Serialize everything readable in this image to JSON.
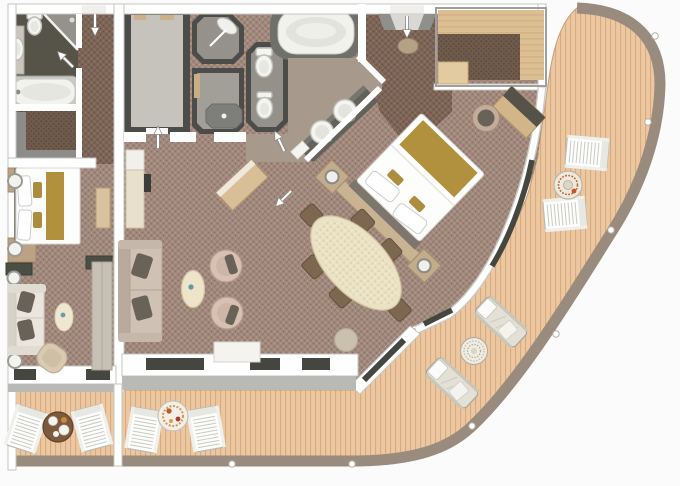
{
  "alt": "Top-down architectural floor plan of a two-bedroom ship suite with bathrooms, walk-in closets, living-dining room and a large curved teak balcony with deck furniture. No text labels are rendered in the image.",
  "visible_text": [],
  "colors": {
    "bg": "#fbfbfb",
    "wall": "#ffffff",
    "wall-edge": "#c6c6c3",
    "carpet-base": "#a28b7e",
    "carpet-dot-dark": "#8b7266",
    "carpet-dot-light": "#b59e90",
    "corridor-base": "#7d6557",
    "corridor-dot-dark": "#6a5244",
    "corridor-dot-light": "#8f7868",
    "closet-floor-base": "#6e5b4c",
    "closet-floor-dot": "#5c4a3c",
    "deck": "#ecc79f",
    "deck-line": "#d5ab84",
    "rail": "#998b7e",
    "dark-room": "#4c4c4a",
    "bath-dark-floor": "#565349",
    "bath-gray-floor": "#95928c",
    "bath-taupe-floor": "#a79a8d",
    "closet-light-floor": "#c6c2bc",
    "counter-dark": "#62625b",
    "fixture-white": "#f4f4f1",
    "fixture-stroke": "#bcbcb7",
    "tub-surround": "#70706a",
    "glass-dark": "#45463f",
    "wood": "#dcbf93",
    "wood-dark": "#b89a6f",
    "gold": "#b2913e",
    "bed-white": "#fdfdfb",
    "sofa-beige": "#cfc2b4",
    "pillow-dark": "#696258",
    "armchair-pink": "#d8c1b2",
    "chair-brown": "#7d6750",
    "table-cream": "#ebe2c6",
    "ledge-gray": "#b9b9b5",
    "outdoor-white": "#fdfdfc",
    "lounger-beige": "#e3e0d6",
    "wood-table-brown": "#7c5a3e",
    "accent-orange": "#c2571f",
    "accent-teal": "#5d98a8"
  }
}
